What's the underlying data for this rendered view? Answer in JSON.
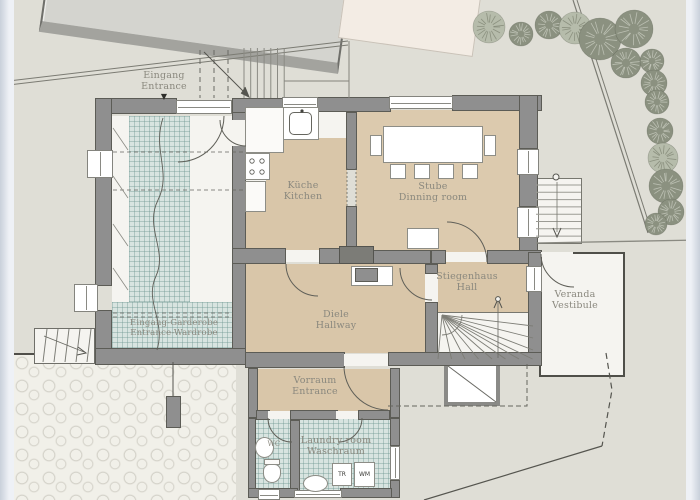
{
  "rooms": {
    "eingang": {
      "line1": "Eingang",
      "line2": "Entrance"
    },
    "kueche": {
      "line1": "Küche",
      "line2": "Kitchen"
    },
    "stube": {
      "line1": "Stube",
      "line2": "Dinning room"
    },
    "diele": {
      "line1": "Diele",
      "line2": "Hallway"
    },
    "stiegenhaus": {
      "line1": "Stiegenhaus",
      "line2": "Hall"
    },
    "veranda": {
      "line1": "Veranda",
      "line2": "Vestibule"
    },
    "vorraum": {
      "line1": "Vorraum",
      "line2": "Entrance"
    },
    "garderobe": {
      "line1": "Eingang-Garderobe",
      "line2": "Entrance-Wardrobe"
    },
    "laundry": {
      "line1": "Laundry room",
      "line2": "Waschraum"
    },
    "wc": {
      "label": "WC"
    }
  },
  "appliances": {
    "dryer": "TR",
    "washer": "WM"
  },
  "marker": {
    "entrance_arrow": "▼"
  },
  "colors": {
    "background": "#dfded6",
    "wall": "#8f8f8f",
    "wood_floor": "#d9c6a9",
    "tile_floor": "#d8e4e0",
    "tree": "#8b9180",
    "label_text": "#8a887e"
  }
}
